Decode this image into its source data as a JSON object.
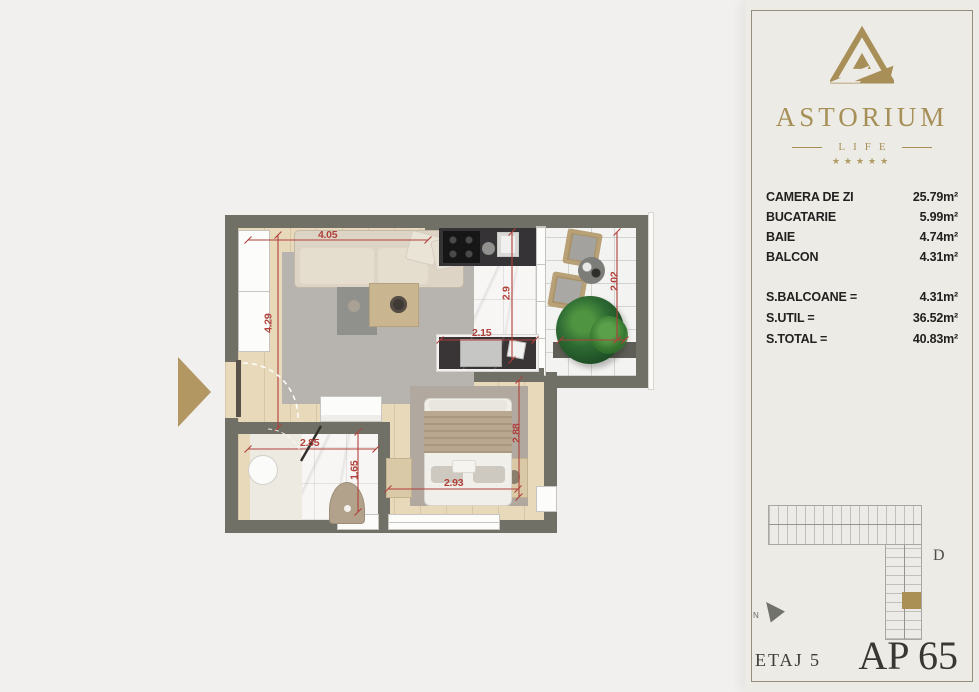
{
  "sidebar": {
    "brand_name": "ASTORIUM",
    "brand_sub": "LIFE",
    "stars": "★★★★★",
    "rooms": [
      {
        "label": "CAMERA DE ZI",
        "value": "25.79m²"
      },
      {
        "label": "BUCATARIE",
        "value": "5.99m²"
      },
      {
        "label": "BAIE",
        "value": "4.74m²"
      },
      {
        "label": "BALCON",
        "value": "4.31m²"
      }
    ],
    "totals": [
      {
        "label": "S.BALCOANE =",
        "value": "4.31m²"
      },
      {
        "label": "S.UTIL =",
        "value": "36.52m²"
      },
      {
        "label": "S.TOTAL =",
        "value": "40.83m²"
      }
    ],
    "building_section_label": "D",
    "north_label": "N",
    "floor_label": "ETAJ 5",
    "apartment_label": "AP 65"
  },
  "plan": {
    "dimensions": [
      {
        "name": "living-width",
        "text": "4.05"
      },
      {
        "name": "living-height",
        "text": "4.29"
      },
      {
        "name": "kitchen-depth",
        "text": "2.9"
      },
      {
        "name": "kitchen-width",
        "text": "2.15"
      },
      {
        "name": "balcony-depth",
        "text": "2.02"
      },
      {
        "name": "sleeping-depth",
        "text": "2.88"
      },
      {
        "name": "sleeping-width",
        "text": "2.93"
      },
      {
        "name": "bathroom-width",
        "text": "2.85"
      },
      {
        "name": "bathroom-depth",
        "text": "1.65"
      }
    ]
  },
  "colors": {
    "accent_gold": "#a69058",
    "wall_gray": "#707066",
    "dimension_red": "#b0403a",
    "entrance_arrow_gold": "#b29763",
    "highlight_unit_gold": "#ab9055"
  }
}
